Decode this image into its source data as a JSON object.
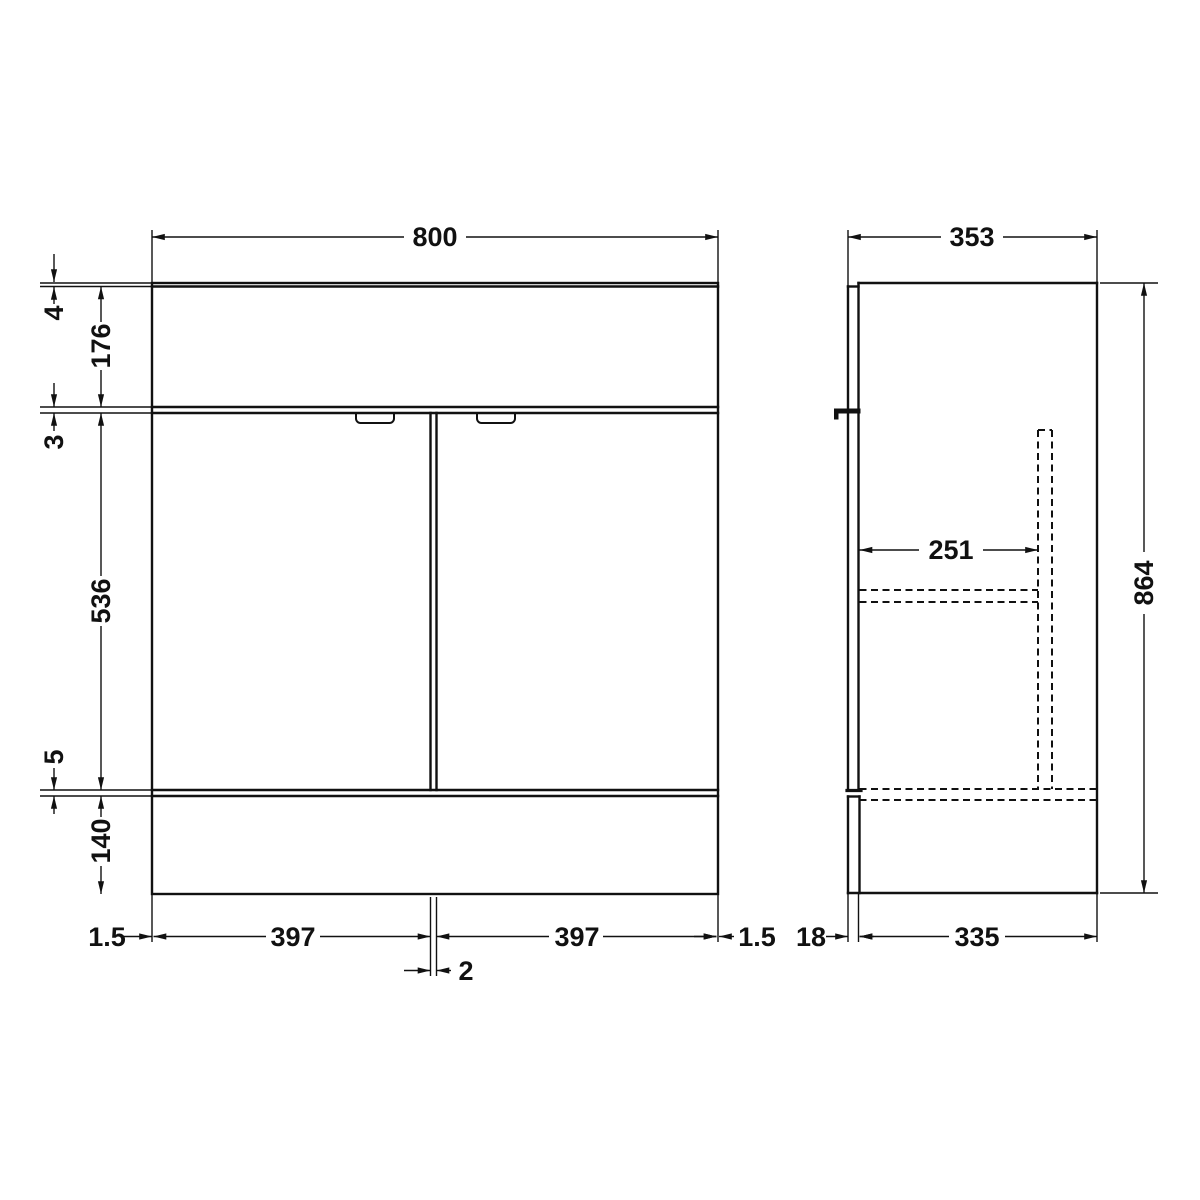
{
  "drawing": {
    "type": "technical-dimension-drawing",
    "subject": "vanity-unit-elevations",
    "colors": {
      "line": "#111111",
      "background": "#ffffff"
    },
    "front": {
      "width": "800",
      "top_lip": "4",
      "basin_section_height": "176",
      "gap_below_basin": "3",
      "door_height": "536",
      "gap_above_plinth": "5",
      "plinth_height": "140",
      "inset_left": "1.5",
      "door_width_left": "397",
      "door_gap": "2",
      "door_width_right": "397",
      "inset_right": "1.5"
    },
    "side": {
      "depth": "353",
      "internal_recess_depth": "251",
      "overall_height": "864",
      "front_panel_thickness": "18",
      "carcass_depth": "335"
    }
  }
}
